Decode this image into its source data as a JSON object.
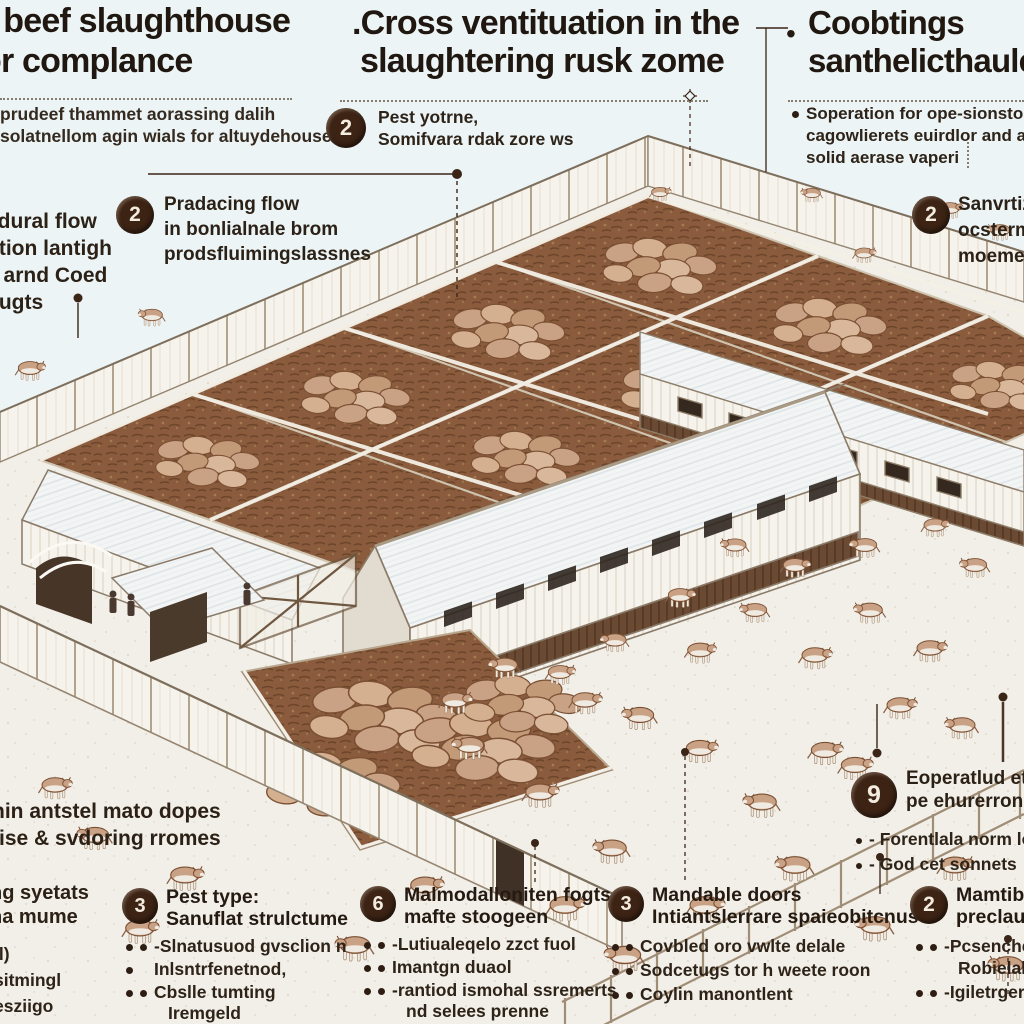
{
  "palette": {
    "bg": "#ecf4f6",
    "ink": "#281d13",
    "badge_bg": "#3c2314",
    "dirt": "#8a5c3d",
    "cow": "#c9a184"
  },
  "header": {
    "left": {
      "title1": "l beef slaughthouse",
      "title2": "or complance",
      "sub1": "prudeef thammet aorassing dalih",
      "sub2": "solatnellom agin wials for altuydehouse"
    },
    "center": {
      "title1": ".Cross ventituation  in the",
      "title2": "slaughtering rusk zome"
    },
    "right": {
      "bullet": "•",
      "title1": "Coobtings",
      "title2": "santhelicthaule",
      "sub1": "Soperation for ope-sionstol pa",
      "sub2": "cagowlierets euirdlor and and oc",
      "sub3": "solid aerase vaperi"
    }
  },
  "callouts": {
    "top_center": {
      "num": "2",
      "l1": "Pest yotrne,",
      "l2": "Somifvara rdak zore ws"
    },
    "left_flow": {
      "num": "2",
      "l1": "Pradacing flow",
      "l2": "in bonlialnale brom",
      "l3": "prodsfluimingslassnes"
    },
    "left_edge": {
      "l1": "adural flow",
      "l2": "ittion lantigh",
      "l3": "e arnd Coed",
      "l4": "bugts"
    },
    "right_sanit": {
      "num": "2",
      "l1": "Sanvrtizz",
      "l2": "ocsterma",
      "l3": "moemer"
    },
    "nine": {
      "num": "9",
      "l1": "Eoperatlud etojd",
      "l2": "pe ehurerron flo (",
      "b1": "- Forentlala norm lo",
      "b2": "- God cet sonnets"
    },
    "mid_left": {
      "l1": "hin antstel mato dopes",
      "l2": "tise & svdoring rromes"
    },
    "bottom_far_left": {
      "l1": "ng syetats",
      "l2": "na mume",
      "f1": "il)",
      "f2": "sitmingl",
      "f3": "esziigo"
    },
    "pest_type": {
      "num": "3",
      "t1": "Pest type:",
      "t2": "Sanuflat strulctume",
      "b1": "-Slnatusuod gvsclion n",
      "b2": "Inlsntrfenetnod,",
      "b3": "Cbslle tumting",
      "b4": "Iremgeld"
    },
    "storage": {
      "num": "6",
      "t1": "Malmodalloniten fogts",
      "t2": "mafte stoogeen",
      "b1": "-Lutiualeqelo zzct fuol",
      "b2": "Imantgn duaol",
      "b3": "-rantiod ismohal ssremerts",
      "b4": "nd selees prenne"
    },
    "doors": {
      "num": "3",
      "t1": "Mandable doors",
      "t2": "Intiantslerrare spaieobitcnus",
      "b1": "Covbled oro vwlte delale",
      "b2": "Sodcetugs tor h weete roon",
      "b3": "Coylin manontlent"
    },
    "mantible": {
      "num": "2",
      "t1": "Mamtible",
      "t2": "preclaul",
      "b1": "-Pcsenche",
      "b2": "Robielal (",
      "b3": "-Igiletrger"
    }
  }
}
